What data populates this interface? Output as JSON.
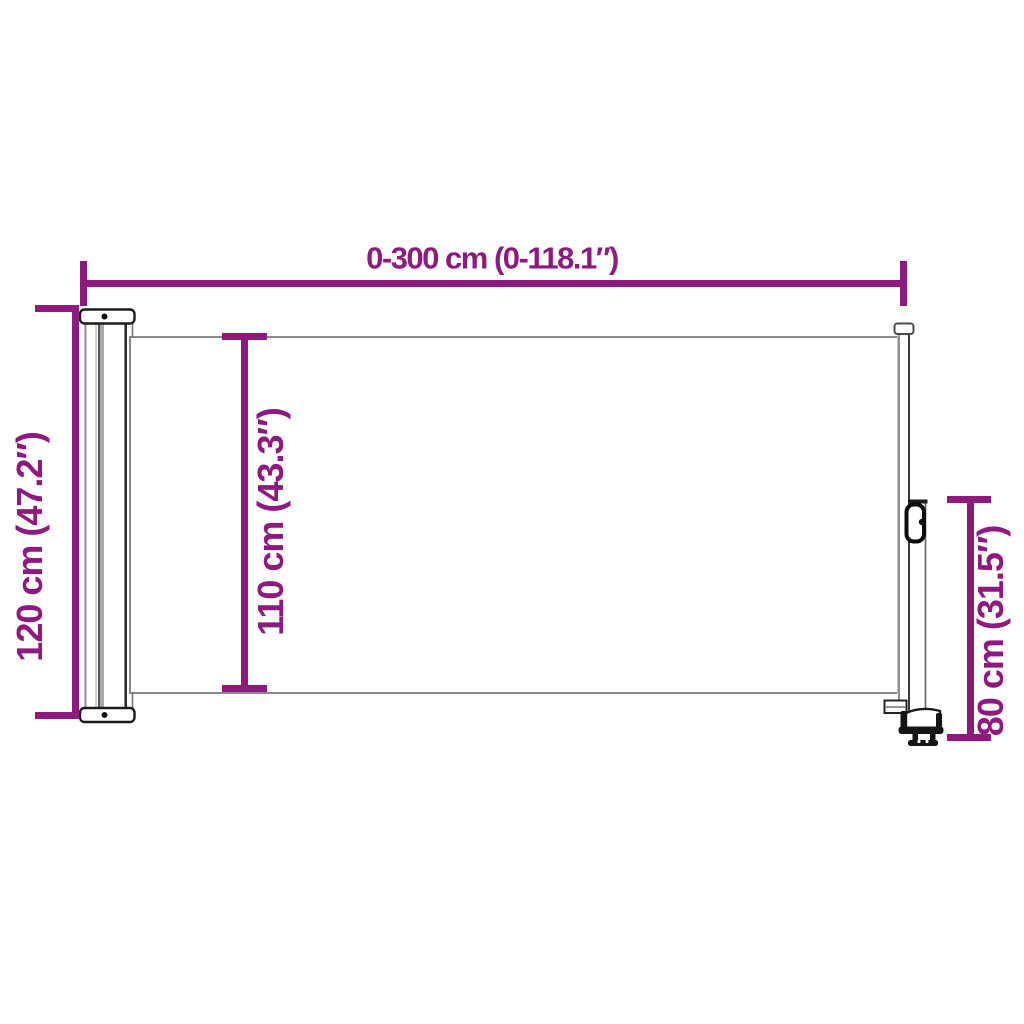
{
  "colors": {
    "accent": "#8e1a80",
    "outline_gray": "#8a8a8a",
    "outline_dark": "#1a1a1a",
    "background": "#ffffff"
  },
  "dimension_labels": {
    "width": "0-300 cm (0-118.1″)",
    "height_left": "120 cm (47.2″)",
    "height_middle": "110 cm (43.3″)",
    "height_right": "80 cm (31.5″)"
  }
}
